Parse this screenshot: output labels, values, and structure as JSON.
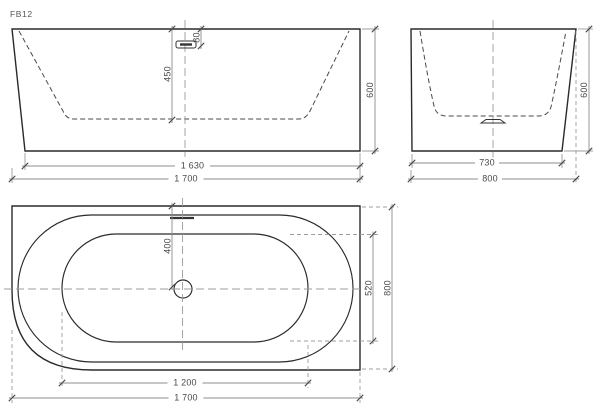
{
  "drawing": {
    "code": "FB12",
    "views": {
      "front": {
        "dims": {
          "depth": "450",
          "overflow_offset": "80",
          "height": "600",
          "bottom_length": "1 630",
          "overall_length": "1 700"
        }
      },
      "side": {
        "dims": {
          "bottom_width": "730",
          "overall_width": "800",
          "height": "600"
        }
      },
      "plan": {
        "dims": {
          "drain_from_back": "400",
          "inner_width": "520",
          "overall_width": "800",
          "inner_length": "1 200",
          "overall_length": "1 700"
        }
      }
    }
  }
}
